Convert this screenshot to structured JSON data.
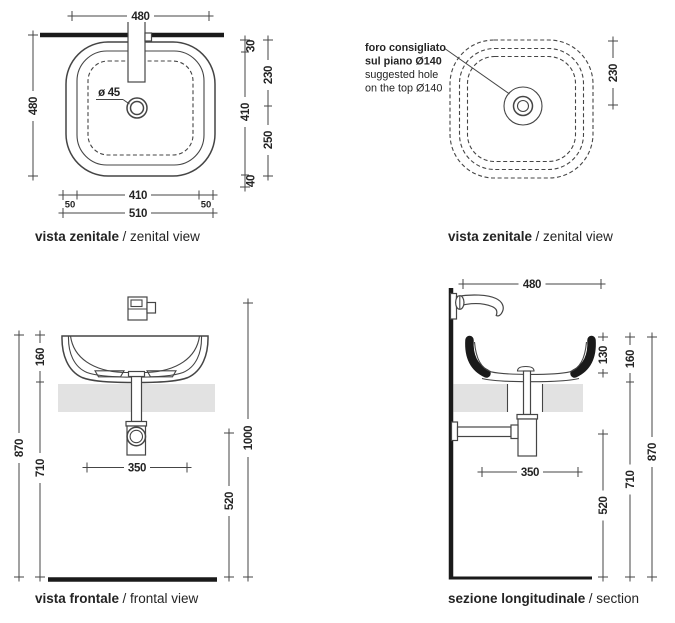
{
  "colors": {
    "line": "#454545",
    "heavy": "#1a1a1a",
    "text": "#242424",
    "shelf_fill": "#e2e2e2",
    "background": "#ffffff"
  },
  "drawing": {
    "zenital_left": {
      "label": {
        "bold": "vista zenitale",
        "rest": "/ zenital view"
      },
      "dims": {
        "top_width": "480",
        "left_height": "480",
        "drain_diameter": "ø 45",
        "bottom_inner": "410",
        "bottom_margin_left": "50",
        "bottom_margin_right": "50",
        "bottom_total": "510",
        "edge_top": "30",
        "depth_inner": "410",
        "edge_bottom": "40",
        "wall_to_drain": "230",
        "drain_to_front": "250"
      }
    },
    "zenital_right": {
      "label": {
        "bold": "vista zenitale",
        "rest": "/ zenital view"
      },
      "note": {
        "it_line1": "foro consigliato",
        "it_line2": "sul piano Ø140",
        "en_line1": "suggested hole",
        "en_line2": "on the top Ø140"
      },
      "dims": {
        "wall_to_drain": "230"
      }
    },
    "frontal": {
      "label": {
        "bold": "vista frontale",
        "rest": "/ frontal view"
      },
      "dims": {
        "basin_height": "160",
        "total_height": "870",
        "under_basin": "710",
        "trap_width": "350",
        "outlet_height": "520",
        "mixer_height": "1000"
      }
    },
    "section": {
      "label": {
        "bold": "sezione longitudinale",
        "rest": "/ section"
      },
      "dims": {
        "depth": "480",
        "bowl_inner_depth": "130",
        "basin_height": "160",
        "total_height": "870",
        "under_basin": "710",
        "trap_width": "350",
        "outlet_height": "520"
      }
    }
  }
}
